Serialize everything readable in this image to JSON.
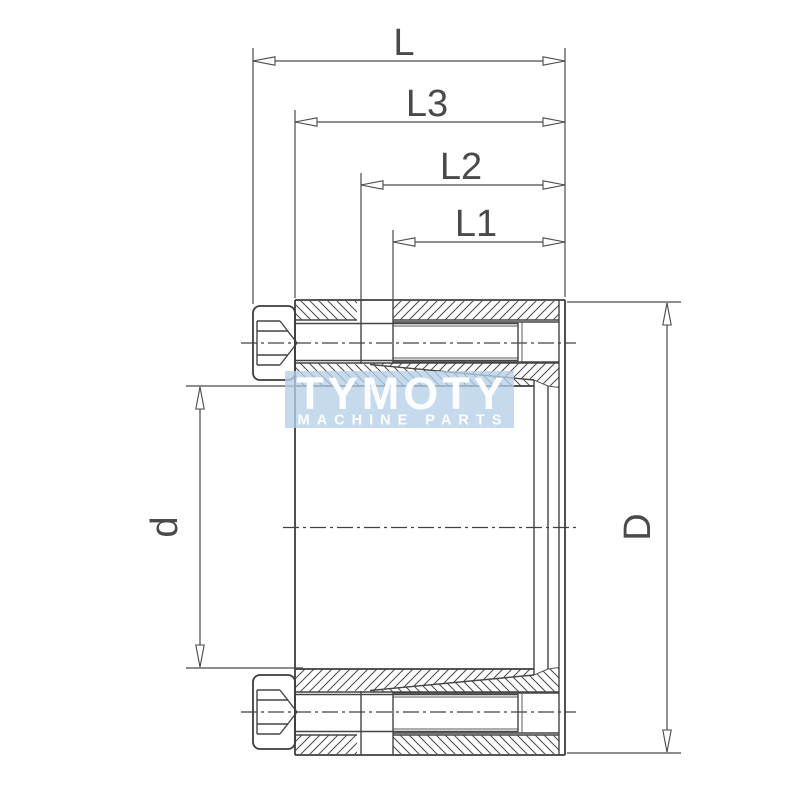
{
  "drawing": {
    "kind": "locking-assembly-section-drawing",
    "dimension_labels": {
      "overall_length": "L",
      "l3": "L3",
      "l2": "L2",
      "l1": "L1",
      "bore_diameter": "d",
      "outer_diameter": "D"
    },
    "watermark": {
      "title": "TYMOTY",
      "subtitle": "MACHINE PARTS"
    },
    "colors": {
      "line": "#3d3d3d",
      "dimension": "#4a4a4a",
      "watermark_box": "#b5d0e8",
      "watermark_text": "#ffffff",
      "background": "#ffffff"
    }
  }
}
